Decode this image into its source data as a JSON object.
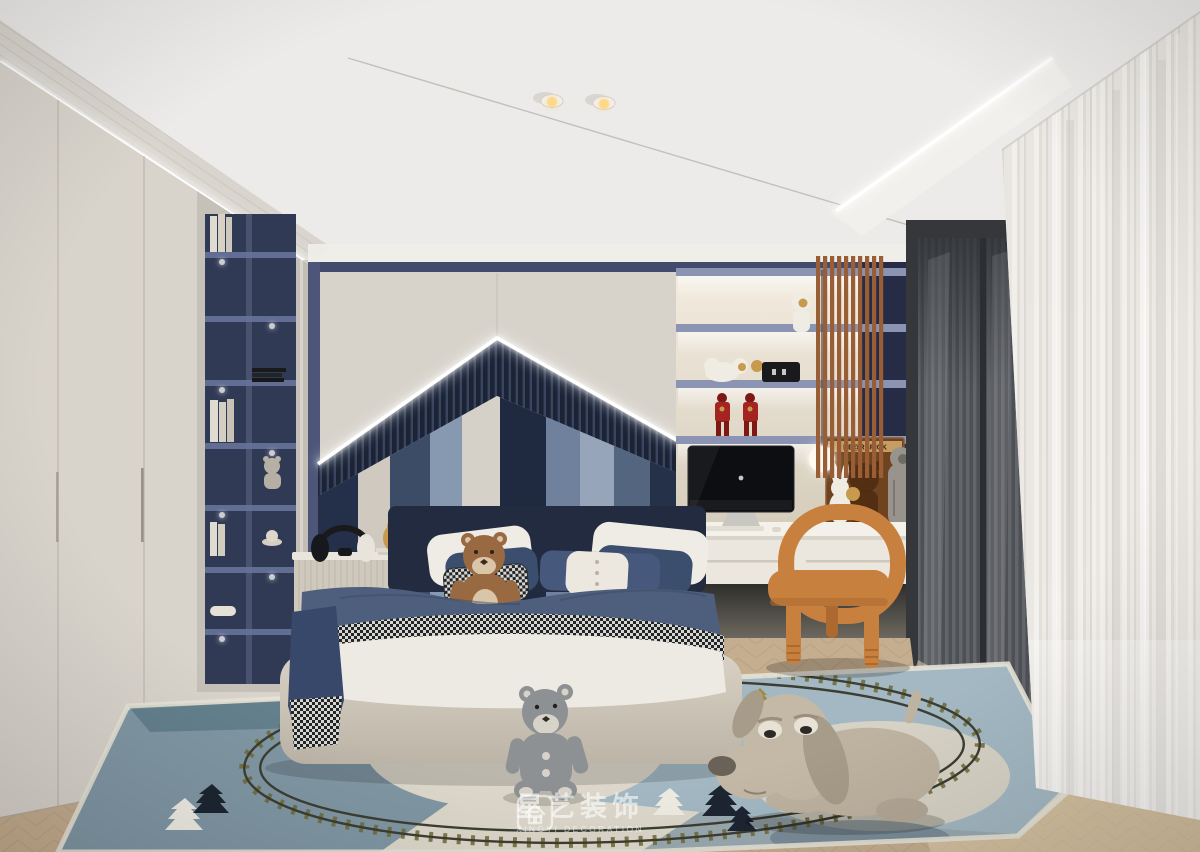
{
  "watermark": {
    "brand_cn": "星艺装饰",
    "brand_en": "XINGYI DECORATION"
  },
  "poster": {
    "title": "BE@RBRICK"
  },
  "objects": [
    "ceiling spotlights",
    "LED cove lighting",
    "wardrobe",
    "bookshelf niche",
    "house-shaped headboard feature wall",
    "striped upholstered headboard panel",
    "double bed",
    "brown teddy bear plush",
    "gray teddy bear plush",
    "dog plush",
    "nightstand",
    "headphones",
    "owl figurine",
    "display shelving",
    "astronaut figurines",
    "iron man action figures",
    "BE@RBRICK poster",
    "rabbit plush",
    "sphere pendant lamp",
    "iMac computer",
    "floating desk",
    "orange kids chair",
    "wood slat screen",
    "fluted glass door",
    "sheer curtain",
    "train-track play rug",
    "herringbone wood floor"
  ],
  "palette": {
    "ceiling": "#ecebe9",
    "ventBand": "#d9d5ce",
    "wallLeft": "#d8d3cb",
    "wallLeftDeep": "#c7c1b8",
    "backWall": "#d7d2ca",
    "trimNavy": "#424b6b",
    "pilasterNavy": "#4d5678",
    "frameGreige": "#c6c1b8",
    "nicheNavy": "#313a55",
    "nicheMullion": "#49526f",
    "shelfThin": "#67739a",
    "ribDark": "#1b2334",
    "ribLight": "#394560",
    "stripes": [
      "#242f49",
      "#cfc9c0",
      "#3d4c66",
      "#8699b1",
      "#d6d1c8",
      "#1f2940",
      "#6f819c",
      "#97a5ba",
      "#54657f",
      "#253049"
    ],
    "ledWhite": "#ffffff",
    "shelfBoard": "#8b94b2",
    "navyColumn": "#262c46",
    "slatWood": "#995e35",
    "posterBrown": "#6f431f",
    "posterBand": "#c69d63",
    "posterDark": "#4f2e12",
    "ironRed": "#a32420",
    "ironRedDeep": "#7e1815",
    "gold": "#c79a4e",
    "clockBlack": "#1a1a1c",
    "astronautWhite": "#efece4",
    "astroGray": "#98938c",
    "bearFig": "#b5afa4",
    "deskTop": "#f4f1ea",
    "deskFront": "#ebe7de",
    "imacBlack": "#0d0e11",
    "imacChin": "#1a1b1f",
    "imacStand": "#c9c7c2",
    "chair": "#c8803f",
    "chairDeep": "#ad6a30",
    "frameDark": "#35373a",
    "glassBase": "#5b5e62",
    "curtain": "#eae7e2",
    "floorWood": "#c5ad8f",
    "floorLight": "#e0cfae",
    "woodLine": "#b1977a",
    "rugBase": "#ddd8cb",
    "rugSlate": "#8097a4",
    "rugSlateDeep": "#5f7b8a",
    "rugBlue": "#a3b8c3",
    "rugBlueMid": "#7e95a4",
    "trackOlive": "#6f6a35",
    "railDark": "#3c3e33",
    "treeNavy": "#1c2531",
    "treeWhite": "#efece4",
    "treeGold": "#9f8a2e",
    "headboardNavy": "#222b3f",
    "pillowWhite": "#efece6",
    "pillowNavy": "#3b4e6d",
    "pillowNavyLt": "#46587c",
    "houndDark": "#20242c",
    "houndLight": "#d9d6cc",
    "blanketNavy": "#4e5f7d",
    "blanketDeep": "#38486a",
    "sheetWhite": "#eceae2",
    "bedBaseTop": "#d8d1c4",
    "bedBaseBot": "#bcb4a7",
    "nightstand": "#cfc8bc",
    "nightstandTop": "#e9e5dc",
    "knobOuter": "#b7ab99",
    "knobMid": "#7a6c58",
    "knobIn": "#463c2e",
    "teddyBrown": "#996a41",
    "teddyMuzzle": "#d9c5a8",
    "plushGray": "#8e9194",
    "plushPad": "#d7d3c8",
    "dogBody": "#beb2a0",
    "dogHead": "#c4b8a6",
    "dogEar": "#a79b89",
    "dogNose": "#6b6257",
    "lampWarm": "#ffd98a",
    "bookWhite": "#e0dbd1",
    "headphoneBlack": "#17181b"
  }
}
